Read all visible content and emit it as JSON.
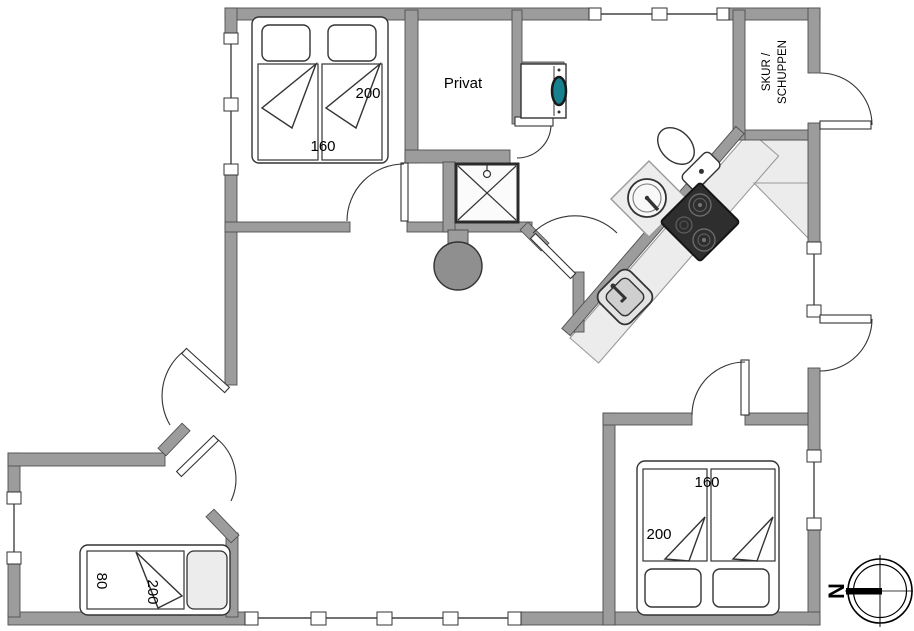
{
  "floorplan": {
    "room_labels": {
      "private": "Privat",
      "shed_line1": "SKUR /",
      "shed_line2": "SCHUPPEN"
    },
    "bed_dimensions": {
      "bedroom_top_left": {
        "length": "200",
        "width": "160"
      },
      "bedroom_bottom_left": {
        "width": "80",
        "length": "200"
      },
      "bedroom_bottom_right": {
        "width": "160",
        "length": "200"
      }
    },
    "compass": {
      "north": "N"
    },
    "fixtures": [
      "double-bed",
      "single-bed",
      "double-bed-2",
      "shower",
      "toilet",
      "bathroom-sink",
      "kitchen-sink",
      "stove-cooktop",
      "washing-machine",
      "fireplace",
      "kitchen-counter"
    ],
    "colors": {
      "wall": "#9c9c9c",
      "wall_outline": "#4f4f4f",
      "counter": "#ececec",
      "stove": "#2e2e2e",
      "fireplace": "#8f8f8f",
      "washer_door": "#17818f",
      "line": "#333333",
      "background": "#ffffff"
    }
  }
}
